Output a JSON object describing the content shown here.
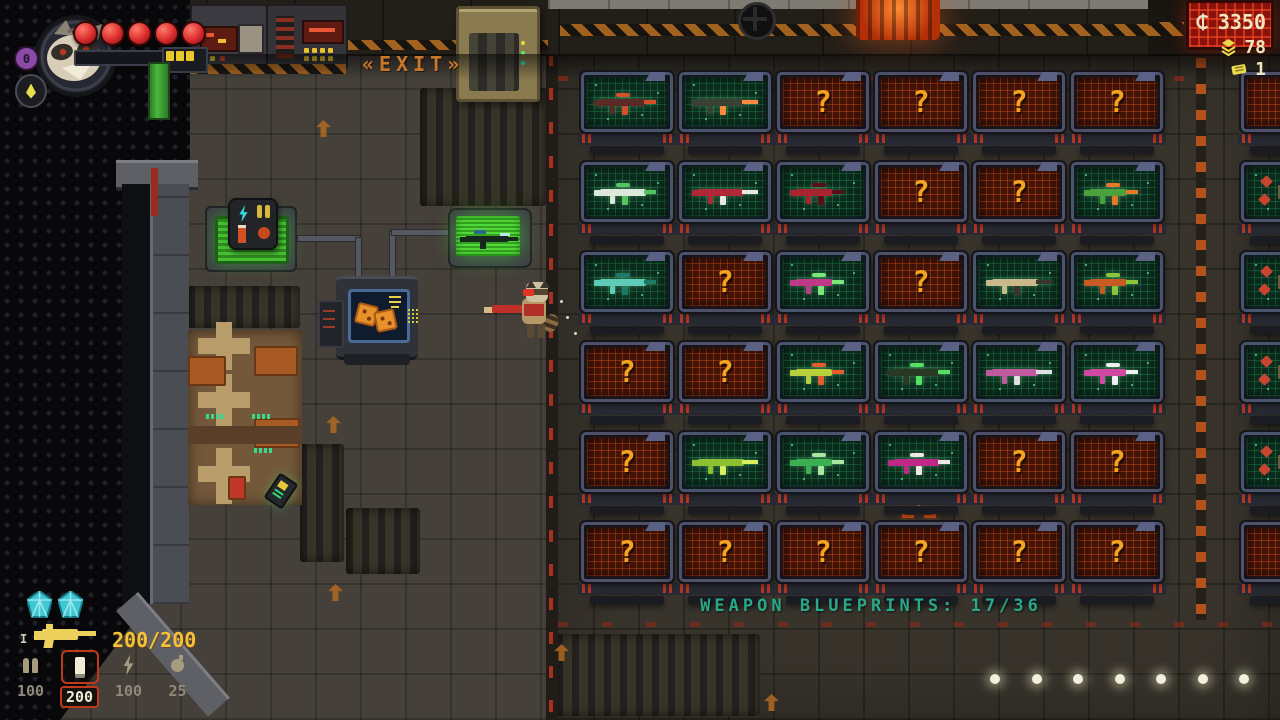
{
  "hud": {
    "level": "0",
    "health_orbs": 5,
    "battery_cells": 3,
    "armor_gems": 2,
    "weapon_slot_marker": "I",
    "weapon_ammo": "200/200",
    "ammo_slots": [
      {
        "name": "bullets",
        "count": "100",
        "selected": false
      },
      {
        "name": "shells",
        "count": "200",
        "selected": true
      },
      {
        "name": "energy",
        "count": "100",
        "selected": false
      },
      {
        "name": "explosives",
        "count": "25",
        "selected": false
      }
    ],
    "currency": {
      "credits": "3350",
      "gems": "78",
      "tickets": "1"
    }
  },
  "room": {
    "exit_prefix": "«",
    "exit_label": "EXIT",
    "exit_suffix": "»",
    "blueprints_title": "WEAPON BLUEPRINTS: 17/36",
    "unknown_glyph": "?",
    "floor_lights": 7
  },
  "colors": {
    "locked_screen": "#431408",
    "unlocked_screen": "#0b2c1d",
    "question": "#f4a41e",
    "title": "#2aa88a",
    "hud_text": "#f0e4c0",
    "selected_ammo": "#c0391e"
  },
  "blueprint_grid": {
    "cols": 6,
    "rows": 6,
    "tiles": [
      {
        "state": "weapon",
        "body": "#5a2a26",
        "accent": "#d4502a"
      },
      {
        "state": "weapon",
        "body": "#3a4034",
        "accent": "#ff8a3a"
      },
      {
        "state": "unknown"
      },
      {
        "state": "unknown"
      },
      {
        "state": "unknown"
      },
      {
        "state": "unknown"
      },
      {
        "state": "weapon",
        "body": "#dce8da",
        "accent": "#54c460"
      },
      {
        "state": "weapon",
        "body": "#b02836",
        "accent": "#e8e8e8"
      },
      {
        "state": "weapon",
        "body": "#a82430",
        "accent": "#5a0f16"
      },
      {
        "state": "unknown"
      },
      {
        "state": "unknown"
      },
      {
        "state": "weapon",
        "body": "#4aa23c",
        "accent": "#e87828"
      },
      {
        "state": "weapon",
        "body": "#5ecab8",
        "accent": "#1e7a68"
      },
      {
        "state": "unknown"
      },
      {
        "state": "weapon",
        "body": "#c03888",
        "accent": "#7ae878"
      },
      {
        "state": "unknown"
      },
      {
        "state": "weapon",
        "body": "#cbb98c",
        "accent": "#3a342a"
      },
      {
        "state": "weapon",
        "body": "#c85a24",
        "accent": "#8cc43c"
      },
      {
        "state": "unknown"
      },
      {
        "state": "unknown"
      },
      {
        "state": "weapon",
        "body": "#b8d03c",
        "accent": "#e85c2c"
      },
      {
        "state": "weapon",
        "body": "#2a3824",
        "accent": "#56e060"
      },
      {
        "state": "weapon",
        "body": "#c05aa0",
        "accent": "#e0e0e0"
      },
      {
        "state": "weapon",
        "body": "#d048a0",
        "accent": "#f0f0f0"
      },
      {
        "state": "unknown"
      },
      {
        "state": "weapon",
        "body": "#8cc030",
        "accent": "#d8f060"
      },
      {
        "state": "weapon",
        "body": "#3cb050",
        "accent": "#a8e8a0"
      },
      {
        "state": "weapon",
        "body": "#c02888",
        "accent": "#f0e8e8"
      },
      {
        "state": "unknown"
      },
      {
        "state": "unknown"
      },
      {
        "state": "unknown"
      },
      {
        "state": "unknown"
      },
      {
        "state": "unknown"
      },
      {
        "state": "unknown"
      },
      {
        "state": "unknown"
      },
      {
        "state": "unknown"
      }
    ]
  },
  "side_wall": {
    "tiles": [
      {
        "state": "unknown"
      },
      {
        "state": "item"
      },
      {
        "state": "item"
      },
      {
        "state": "item"
      },
      {
        "state": "item"
      },
      {
        "state": "unknown"
      }
    ]
  }
}
